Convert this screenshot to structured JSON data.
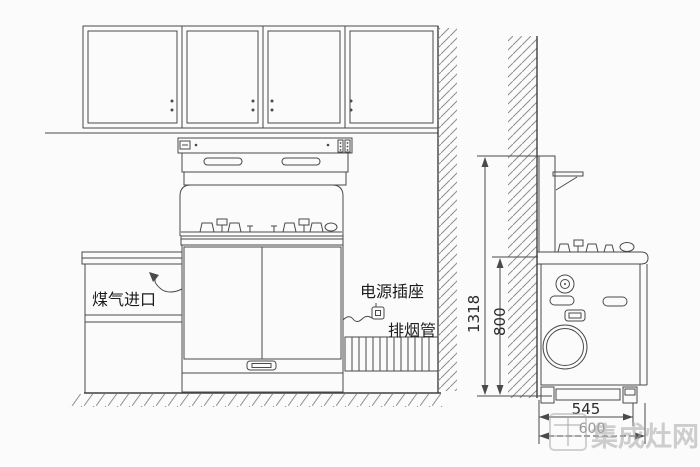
{
  "annotations": {
    "gas_inlet": "煤气进口",
    "power_socket": "电源插座",
    "exhaust_pipe": "排烟管"
  },
  "dimensions": {
    "overall_height": "1318",
    "hob_height": "800",
    "depth": "545",
    "overall_depth": "600"
  },
  "watermark": {
    "text": "集成灶网"
  },
  "colors": {
    "line": "#4a4a4a",
    "text": "#1c1c1c",
    "hatch": "#8f8f8f",
    "watermark": "#a8a8a8",
    "background": "#fbfbfb"
  }
}
